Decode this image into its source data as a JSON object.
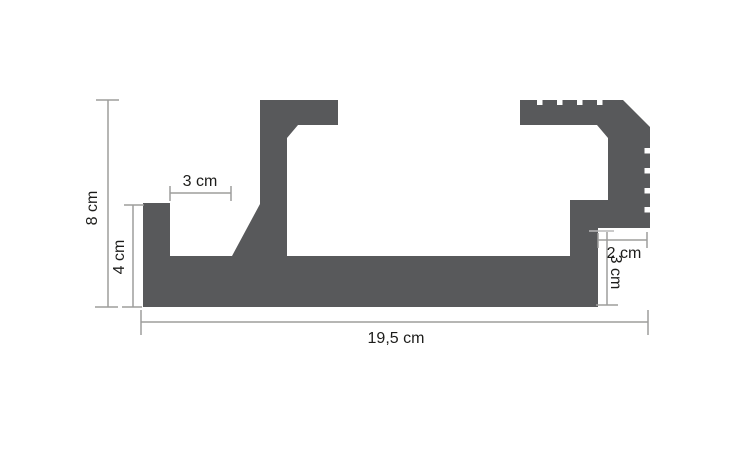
{
  "diagram": {
    "type": "technical-profile-cross-section",
    "unit": "cm",
    "labels": {
      "overall_height": "8 cm",
      "left_tab_height": "4 cm",
      "top_slot_width": "3 cm",
      "overall_width": "19,5 cm",
      "right_notch_width": "2 cm",
      "right_notch_height": "3 cm"
    },
    "colors": {
      "profile_fill": "#58595b",
      "dimension_line": "#9d9d9c",
      "light_tick": "#b9b9b9",
      "label_text": "#1d1d1b",
      "background": "#ffffff"
    }
  }
}
